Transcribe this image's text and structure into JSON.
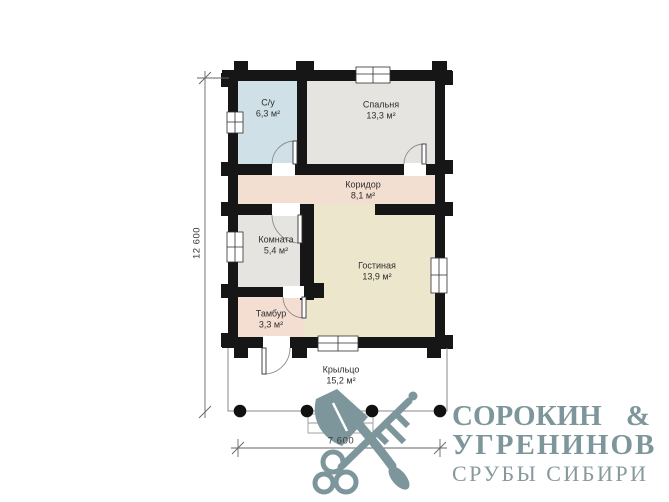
{
  "floor_plan": {
    "rooms": [
      {
        "id": "su",
        "name": "С/у",
        "area": "6,3 м²"
      },
      {
        "id": "bedroom",
        "name": "Спальня",
        "area": "13,3 м²"
      },
      {
        "id": "corridor",
        "name": "Коридор",
        "area": "8,1 м²"
      },
      {
        "id": "room",
        "name": "Комната",
        "area": "5,4 м²"
      },
      {
        "id": "living",
        "name": "Гостиная",
        "area": "13,9 м²"
      },
      {
        "id": "tambour",
        "name": "Тамбур",
        "area": "3,3 м²"
      },
      {
        "id": "porch",
        "name": "Крыльцо",
        "area": "15,2 м²"
      }
    ],
    "dimensions": {
      "vertical": "12 600",
      "horizontal": "7 600"
    },
    "colors": {
      "wall": "#161616",
      "su_fill": "#cfe1e6",
      "bedroom_fill": "#e6e4e0",
      "corridor_fill": "#f3ded2",
      "room_fill": "#e6e4e0",
      "living_fill": "#ece7cc",
      "tambour_fill": "#f4ded2",
      "porch_fill": "#ffffff"
    }
  },
  "logo": {
    "company_line1": "СОРОКИН",
    "ampersand": "&",
    "company_line2": "УГРЕНИНОВ",
    "tagline": "СРУБЫ СИБИРИ",
    "brand_color": "#7d969b",
    "icon": "crossed-axe-and-key"
  }
}
